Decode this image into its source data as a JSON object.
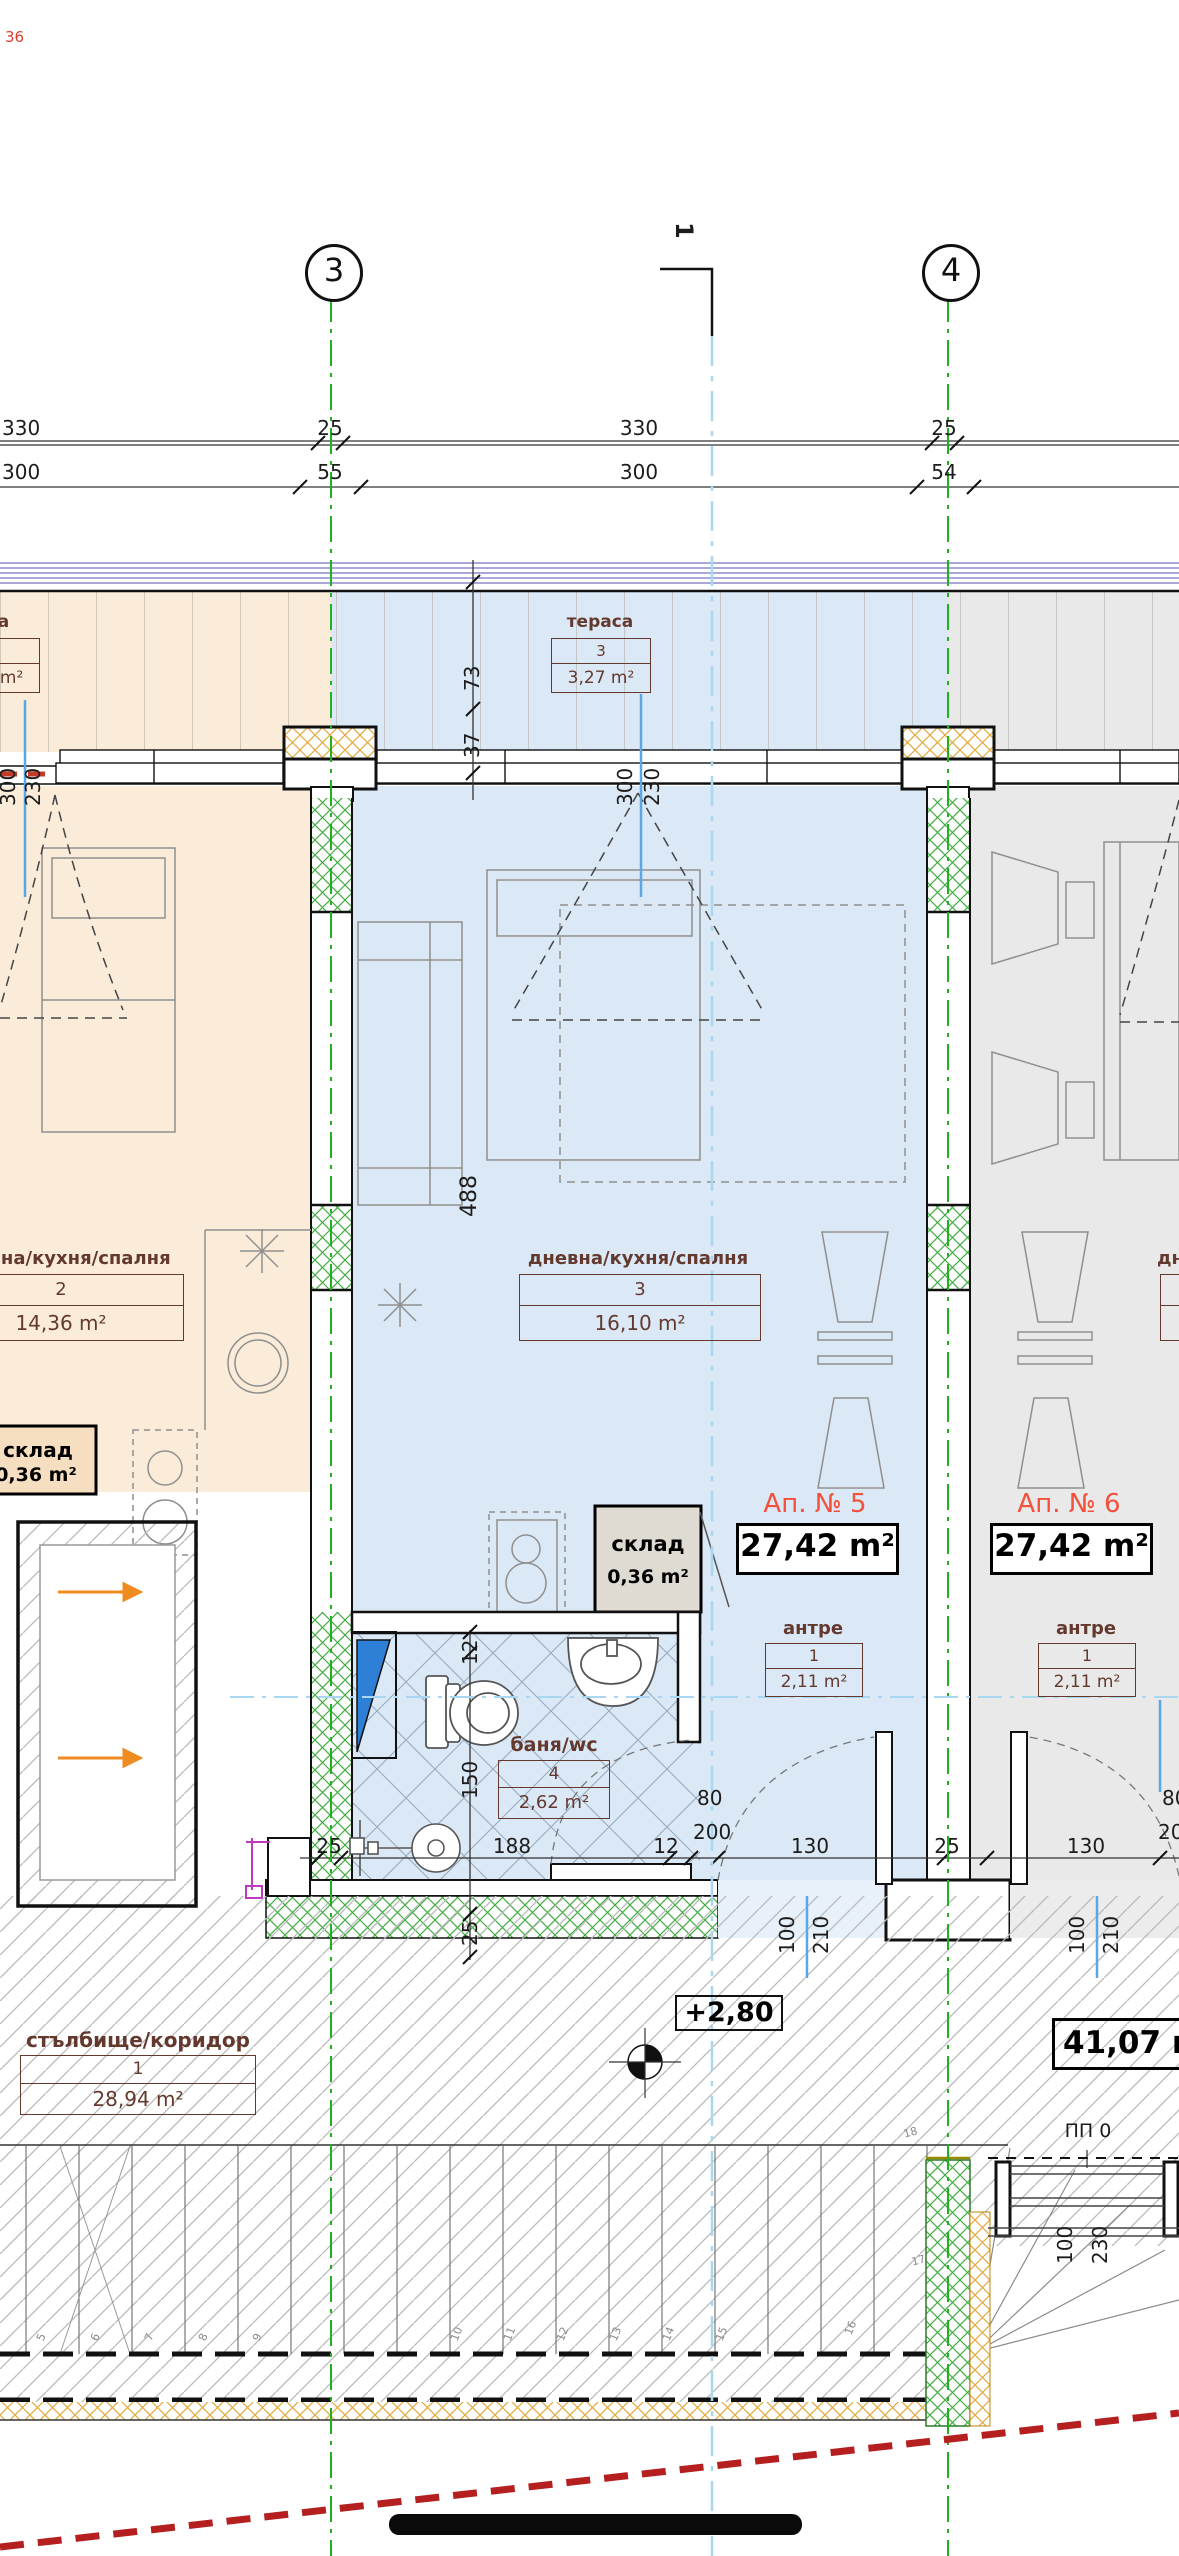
{
  "note_top_left": "36",
  "grid": {
    "axis3": "3",
    "axis4": "4",
    "section_mark": "1"
  },
  "dims": {
    "row1": [
      "330",
      "25",
      "330",
      "25"
    ],
    "row2": [
      "300",
      "55",
      "300",
      "54"
    ],
    "terrace_depth": "73",
    "wall_offset": "37",
    "room_depth": "488",
    "window_left": [
      "300",
      "230"
    ],
    "window_mid": [
      "300",
      "230"
    ],
    "bath_vert": [
      "12",
      "150",
      "25"
    ],
    "bottom_row": [
      "25",
      "188",
      "12",
      "130",
      "25",
      "130"
    ],
    "bath_door": [
      "80",
      "200"
    ],
    "right_door_cut": [
      "80",
      "200"
    ],
    "door_mid": [
      "100",
      "210"
    ],
    "door_right": [
      "100",
      "210"
    ],
    "pp_window": [
      "100",
      "230"
    ]
  },
  "labels": {
    "terrace_left": {
      "title": "тераса",
      "num": "3",
      "area": "3,27 m²"
    },
    "terrace_mid": {
      "title": "тераса",
      "num": "3",
      "area": "3,27 m²"
    },
    "room_left": {
      "title": "дневна/кухня/спалня",
      "num": "2",
      "area": "14,36 m²"
    },
    "room_mid": {
      "title": "дневна/кухня/спалня",
      "num": "3",
      "area": "16,10 m²"
    },
    "room_right": {
      "title": "дневна/кухня/спалня"
    },
    "antre_mid": {
      "title": "антре",
      "num": "1",
      "area": "2,11 m²"
    },
    "antre_right": {
      "title": "антре",
      "num": "1",
      "area": "2,11 m²"
    },
    "bath": {
      "title": "баня/wc",
      "num": "4",
      "area": "2,62 m²"
    },
    "sklad_mid": {
      "title": "склад",
      "area": "0,36 m²"
    },
    "sklad_left": {
      "title": "склад",
      "area": "0,36 m²"
    },
    "ap5": {
      "name": "Ап. № 5",
      "area": "27,42 m²"
    },
    "ap6": {
      "name": "Ап. № 6",
      "area": "27,42 m²"
    },
    "koridor": {
      "title": "стълбище/коридор",
      "num": "1",
      "area": "28,94 m²"
    },
    "total_area": "41,07 m²",
    "level": "+2,80",
    "pp0": "ПП 0"
  },
  "stairs": {
    "numbers": [
      "5",
      "6",
      "7",
      "8",
      "9",
      "10",
      "11",
      "12",
      "13",
      "14",
      "15",
      "16",
      "17",
      "18"
    ]
  },
  "colors": {
    "accent_red": "#f4503c",
    "label_brown": "#63392e",
    "grid_green": "#1fb11f",
    "section_blue": "#a9d7f2",
    "floor_orange": "#faecd9",
    "floor_blue": "#dbe8f6",
    "floor_gray": "#e9e9e9",
    "hatch_green": "#44ad44"
  }
}
